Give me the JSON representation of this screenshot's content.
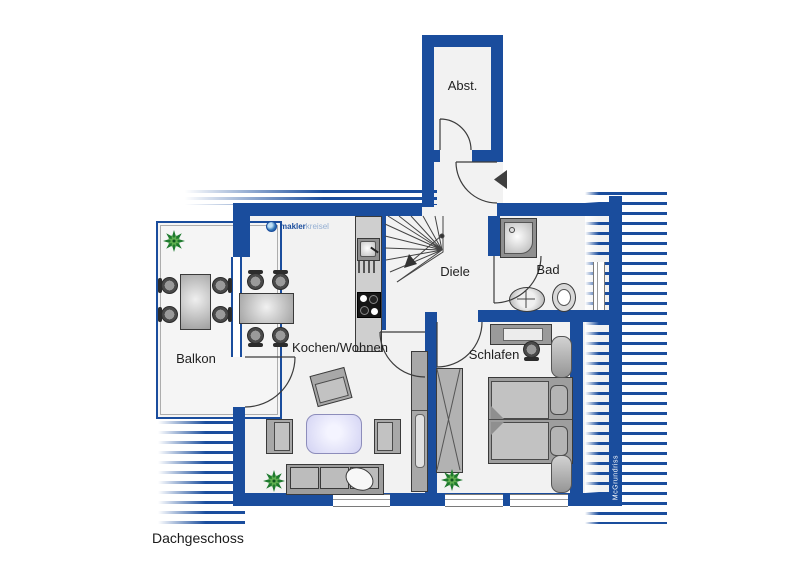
{
  "floor_label": "Dachgeschoss",
  "logo": {
    "part1": "makler",
    "part2": "kreisel"
  },
  "watermark": "McGrundriss",
  "rooms": {
    "abst": "Abst.",
    "diele": "Diele",
    "bad": "Bad",
    "kochen": "Kochen/Wohnen",
    "schlafen": "Schlafen",
    "balkon": "Balkon"
  },
  "colors": {
    "wall": "#1a4d9d",
    "floor": "#f2f2f2",
    "rug": "#d8d8f5",
    "plant": "#1e7a2e",
    "furniture": "#a8a8a8"
  }
}
